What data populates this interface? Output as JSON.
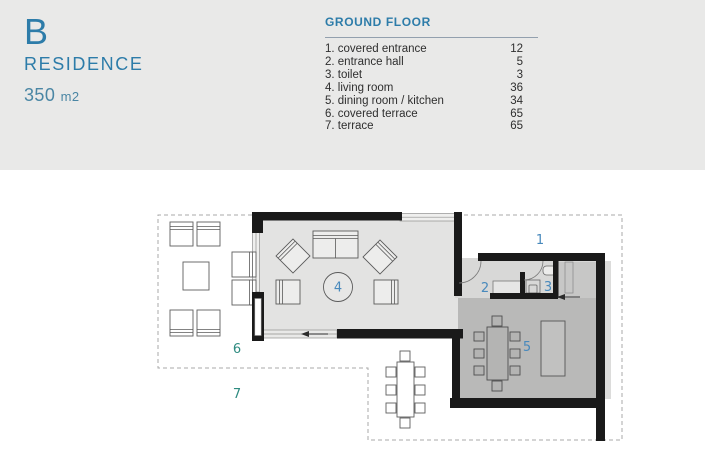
{
  "header": {
    "building_letter": "B",
    "building_type": "RESIDENCE",
    "area_value": "350",
    "area_unit": "m2"
  },
  "legend": {
    "title": "GROUND FLOOR",
    "items": [
      {
        "name": "1. covered entrance",
        "area": "12"
      },
      {
        "name": "2. entrance hall",
        "area": "5"
      },
      {
        "name": "3. toilet",
        "area": "3"
      },
      {
        "name": "4. living room",
        "area": "36"
      },
      {
        "name": "5. dining room / kitchen",
        "area": "34"
      },
      {
        "name": "6. covered terrace",
        "area": "65"
      },
      {
        "name": "7. terrace",
        "area": "65"
      }
    ]
  },
  "plan": {
    "labels": [
      "1",
      "2",
      "3",
      "4",
      "5",
      "6",
      "7"
    ]
  },
  "colors": {
    "accent_blue": "#2d7ca9",
    "area_text_blue": "#4a86a4",
    "room_label_blue": "#4889bc",
    "terrace_label_teal": "#2e8b80",
    "header_band_gray": "#e9e9e8",
    "living_room_floor": "#e3e3e2",
    "dining_room_floor": "#b9b9b8",
    "wall_black": "#1a1a1a"
  }
}
